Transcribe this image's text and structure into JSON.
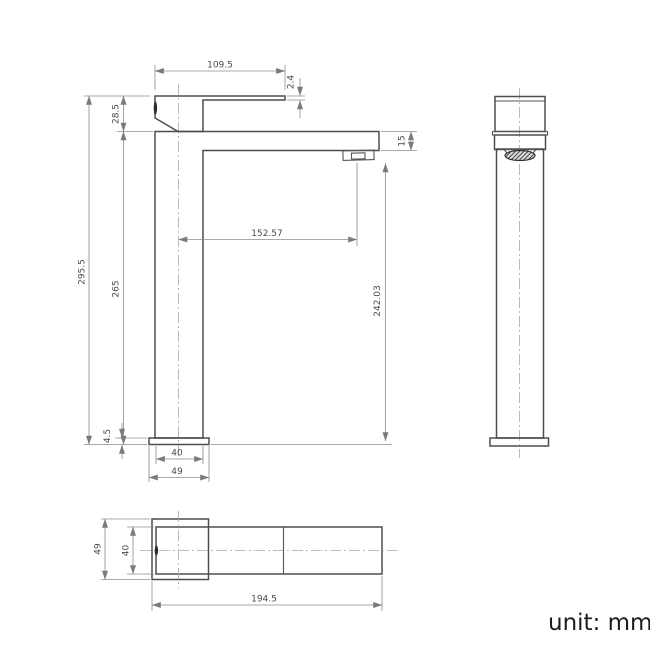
{
  "drawing": {
    "unit_label": "unit: mm",
    "colors": {
      "outline": "#4d4d4d",
      "dimension_lines": "#8c8c8c",
      "centerline": "#a8a8a8",
      "dimension_text": "#4a4a4a"
    },
    "front_view": {
      "dim_lever_length": "109.5",
      "dim_lever_tip_thickness": "2.4",
      "dim_handle_height": "28.5",
      "dim_overall_height": "295.5",
      "dim_body_height": "265",
      "dim_spout_section_height": "15",
      "dim_spout_reach": "152.57",
      "dim_outlet_height": "242.03",
      "dim_base_plate_thickness": "4.5",
      "dim_body_width": "40",
      "dim_base_width": "49"
    },
    "top_view": {
      "dim_base_depth": "49",
      "dim_body_depth": "40",
      "dim_overall_length": "194.5"
    }
  }
}
